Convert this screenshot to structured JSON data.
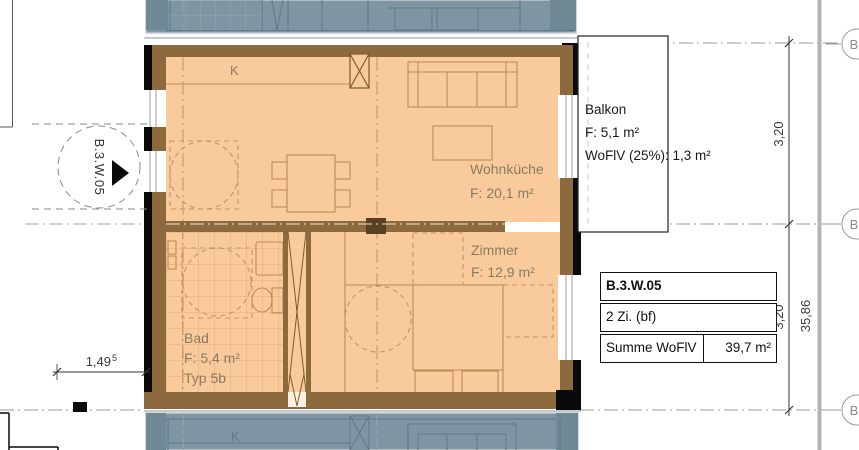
{
  "colors": {
    "floor": "#f9cb9c",
    "wall": "#8d6a3e",
    "wall_dark": "#5a4022",
    "furniture_line": "#bc8a58",
    "neighbor_fill": "#7f95a2",
    "neighbor_line": "#5e7a88",
    "label_text": "#8c7a60",
    "dimension_text": "#3a3a3a",
    "grid_line": "#9b9b9b",
    "black": "#0a0a0a"
  },
  "unit_marker": {
    "label": "B.3.W.05"
  },
  "rooms": {
    "wohnkueche": {
      "name": "Wohnküche",
      "area": "F: 20,1 m²"
    },
    "zimmer": {
      "name": "Zimmer",
      "area": "F: 12,9 m²"
    },
    "bad": {
      "name": "Bad",
      "area": "F: 5,4 m²",
      "typ": "Typ 5b"
    },
    "balkon": {
      "name": "Balkon",
      "area": "F: 5,1 m²",
      "woflv": "WoFlV (25%): 1,3 m²"
    }
  },
  "kitchen": {
    "label": "K"
  },
  "neighbor_bottom": {
    "kitchen_label": "K"
  },
  "dimensions": {
    "segment_top": "3,20",
    "segment_bottom": "3,20",
    "total": "35,86",
    "entry_width": "1,49",
    "entry_width_sup": "5"
  },
  "grid_bubbles": [
    "B",
    "B",
    "B"
  ],
  "info_table": {
    "unit_id": "B.3.W.05",
    "unit_type": "2 Zi. (bf)",
    "sum_label": "Summe WoFlV",
    "sum_value": "39,7 m²"
  }
}
